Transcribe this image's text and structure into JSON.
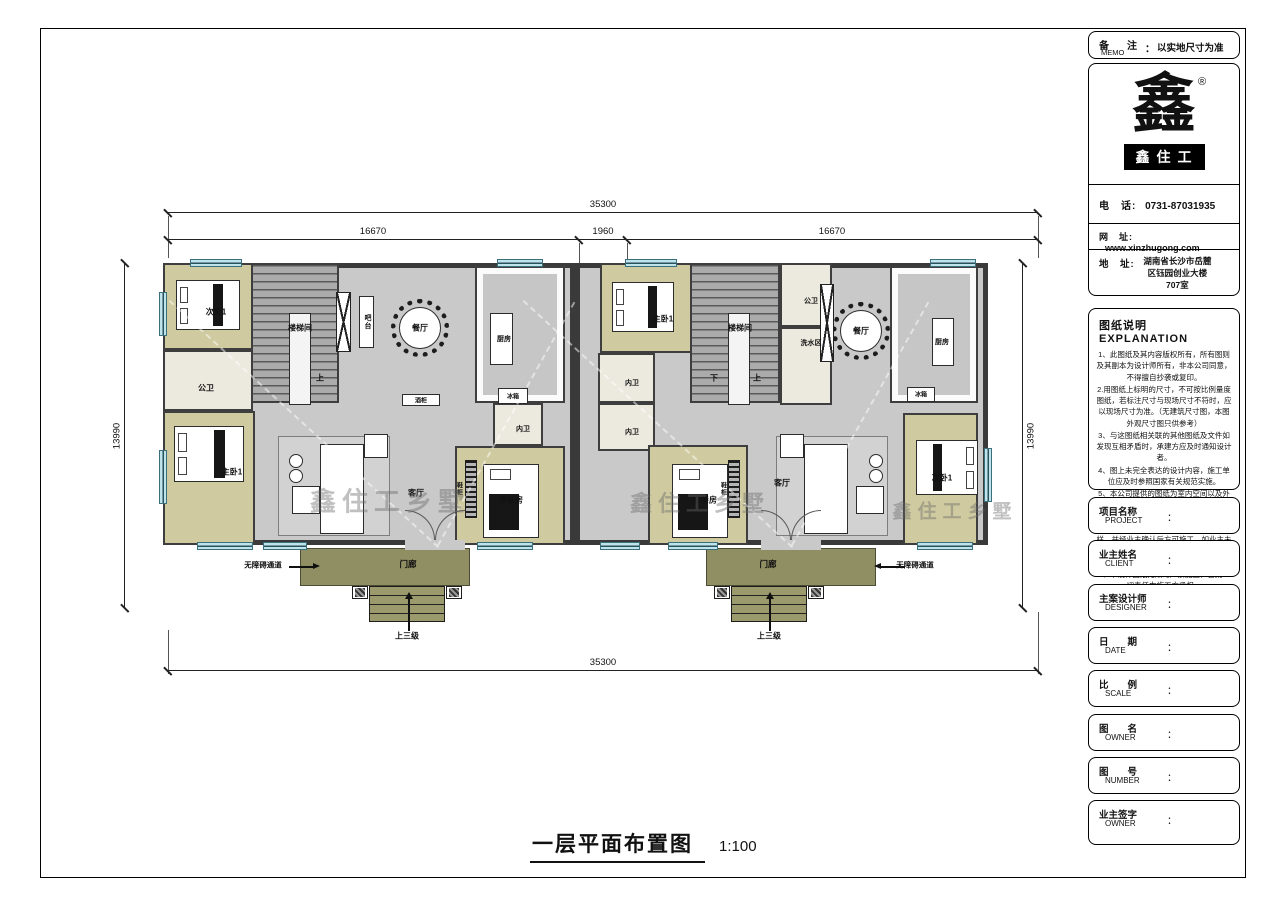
{
  "doc": {
    "memo": {
      "cn": "备　注",
      "en": "MEMO",
      "colon": "：",
      "value": "以实地尺寸为准"
    },
    "logo": {
      "glyph": "鑫",
      "registered": "®",
      "brand": "鑫住工"
    },
    "contact": {
      "phone_label": "电　话:",
      "phone": "0731-87031935",
      "web_label": "网　址:",
      "web": "www.xinzhugong.com",
      "addr_label": "地　址:",
      "addr": "湖南省长沙市岳麓\n区钰园创业大楼\n707室"
    },
    "explanation": {
      "title": "图纸说明  EXPLANATION",
      "notes": [
        "1、此图纸及其内容版权所有，所有图则及其副本为设计师所有，非本公司同意，不得擅自抄袭或复印。",
        "2.用图纸上标明的尺寸，不可按比例量度图纸，若标注尺寸与现场尺寸不符时，应以现场尺寸为准。（无建筑尺寸图，本图外观尺寸图只供参考）",
        "3、与这图纸相关联的其他图纸及文件如发现互相矛盾时，承建方应及时通知设计者。",
        "4、图上未完全表达的设计内容，施工单位应及时参照国家有关规范实施。",
        "5、本公司提供的图纸为室内空间以及外观设计图纸，不具备建筑设计资质如涉及到建筑结构方面的问题仅供参考。",
        "6、本公司提供的图纸施工前必须现场放样，并经业主确认后方可施工，如业主未经确认导致返工，一切责任由施工方面全部承担。",
        "7、本设计图纸无效时严禁施工，否则一切责任由施工方承担。"
      ]
    },
    "fields": [
      {
        "cn": "项目名称",
        "en": "PROJECT",
        "colon": "："
      },
      {
        "cn": "业主姓名",
        "en": "CLIENT",
        "colon": "："
      },
      {
        "cn": "主案设计师",
        "en": "DESIGNER",
        "colon": "："
      },
      {
        "cn": "日　　期",
        "en": "DATE",
        "colon": "："
      },
      {
        "cn": "比　　例",
        "en": "SCALE",
        "colon": "："
      },
      {
        "cn": "图　　名",
        "en": "OWNER",
        "colon": "："
      },
      {
        "cn": "图　　号",
        "en": "NUMBER",
        "colon": "："
      },
      {
        "cn": "业主签字",
        "en": "OWNER",
        "colon": "："
      }
    ]
  },
  "plan": {
    "title": "一层平面布置图",
    "scale": "1:100",
    "watermark": "鑫住工乡墅",
    "dims": {
      "top_total": "35300",
      "top_left": "16670",
      "top_mid": "1960",
      "top_right": "16670",
      "bottom_total": "35300",
      "side_left": "13990",
      "side_right": "13990"
    },
    "units": [
      {
        "name": "left-unit",
        "frame": {
          "x": 163,
          "y": 263,
          "w": 412,
          "h": 282
        },
        "rooms": [
          {
            "type": "bedroom",
            "x": 0,
            "y": 0,
            "w": 90,
            "h": 87
          },
          {
            "type": "bath",
            "x": 0,
            "y": 87,
            "w": 90,
            "h": 61
          },
          {
            "type": "bedroom",
            "x": 0,
            "y": 148,
            "w": 92,
            "h": 134
          },
          {
            "type": "stair",
            "x": 88,
            "y": 0,
            "w": 88,
            "h": 140
          },
          {
            "type": "kitchen",
            "x": 312,
            "y": 3,
            "w": 90,
            "h": 137
          },
          {
            "type": "bath",
            "x": 330,
            "y": 140,
            "w": 50,
            "h": 43
          },
          {
            "type": "bedroom",
            "x": 292,
            "y": 183,
            "w": 110,
            "h": 99
          }
        ],
        "labels": [
          {
            "t": "次卧1",
            "x": 48,
            "y": 44
          },
          {
            "t": "公卫",
            "x": 38,
            "y": 120
          },
          {
            "t": "主卧1",
            "x": 64,
            "y": 204
          },
          {
            "t": "楼梯间",
            "x": 132,
            "y": 60
          },
          {
            "t": "上",
            "x": 152,
            "y": 110
          },
          {
            "t": "吧台",
            "x": 199,
            "y": 54,
            "v": 1,
            "s": 7
          },
          {
            "t": "餐厅",
            "x": 252,
            "y": 60
          },
          {
            "t": "厨房",
            "x": 336,
            "y": 71,
            "s": 7
          },
          {
            "t": "冰箱",
            "x": 345,
            "y": 128,
            "s": 6
          },
          {
            "t": "酒柜",
            "x": 253,
            "y": 132,
            "s": 6
          },
          {
            "t": "内卫",
            "x": 355,
            "y": 161,
            "s": 7
          },
          {
            "t": "孝亲房",
            "x": 343,
            "y": 232
          },
          {
            "t": "客厅",
            "x": 248,
            "y": 225
          },
          {
            "t": "鞋柜",
            "x": 291,
            "y": 221,
            "v": 1,
            "s": 6
          }
        ],
        "porch": {
          "hall": "门廊",
          "steps": "上三级",
          "ramp": "无障碍通道"
        }
      },
      {
        "name": "right-unit",
        "frame": {
          "x": 575,
          "y": 263,
          "w": 413,
          "h": 282
        },
        "rooms": [
          {
            "type": "bedroom",
            "x": 25,
            "y": 0,
            "w": 95,
            "h": 90
          },
          {
            "type": "bath",
            "x": 23,
            "y": 90,
            "w": 57,
            "h": 50
          },
          {
            "type": "bath",
            "x": 23,
            "y": 140,
            "w": 57,
            "h": 48
          },
          {
            "type": "stair",
            "x": 115,
            "y": 0,
            "w": 90,
            "h": 140
          },
          {
            "type": "bath",
            "x": 205,
            "y": 0,
            "w": 52,
            "h": 64
          },
          {
            "type": "bath",
            "x": 205,
            "y": 64,
            "w": 52,
            "h": 78
          },
          {
            "type": "kitchen",
            "x": 315,
            "y": 3,
            "w": 88,
            "h": 137
          },
          {
            "type": "bedroom",
            "x": 73,
            "y": 182,
            "w": 100,
            "h": 100
          },
          {
            "type": "bedroom",
            "x": 328,
            "y": 150,
            "w": 75,
            "h": 132
          }
        ],
        "labels": [
          {
            "t": "主卧1",
            "x": 83,
            "y": 51
          },
          {
            "t": "内卫",
            "x": 52,
            "y": 115,
            "s": 7
          },
          {
            "t": "内卫",
            "x": 52,
            "y": 164,
            "s": 7
          },
          {
            "t": "楼梯间",
            "x": 160,
            "y": 60
          },
          {
            "t": "下",
            "x": 134,
            "y": 110
          },
          {
            "t": "上",
            "x": 177,
            "y": 110
          },
          {
            "t": "公卫",
            "x": 231,
            "y": 33,
            "s": 7
          },
          {
            "t": "洗水区",
            "x": 231,
            "y": 75,
            "s": 7
          },
          {
            "t": "餐厅",
            "x": 281,
            "y": 63
          },
          {
            "t": "厨房",
            "x": 362,
            "y": 74,
            "s": 7
          },
          {
            "t": "冰箱",
            "x": 341,
            "y": 126,
            "s": 6
          },
          {
            "t": "孝亲房",
            "x": 125,
            "y": 232
          },
          {
            "t": "客厅",
            "x": 202,
            "y": 215
          },
          {
            "t": "次卧1",
            "x": 362,
            "y": 210
          },
          {
            "t": "鞋柜",
            "x": 143,
            "y": 221,
            "v": 1,
            "s": 6
          }
        ],
        "porch": {
          "hall": "门廊",
          "steps": "上三级",
          "ramp": "无障碍通道"
        }
      }
    ]
  }
}
